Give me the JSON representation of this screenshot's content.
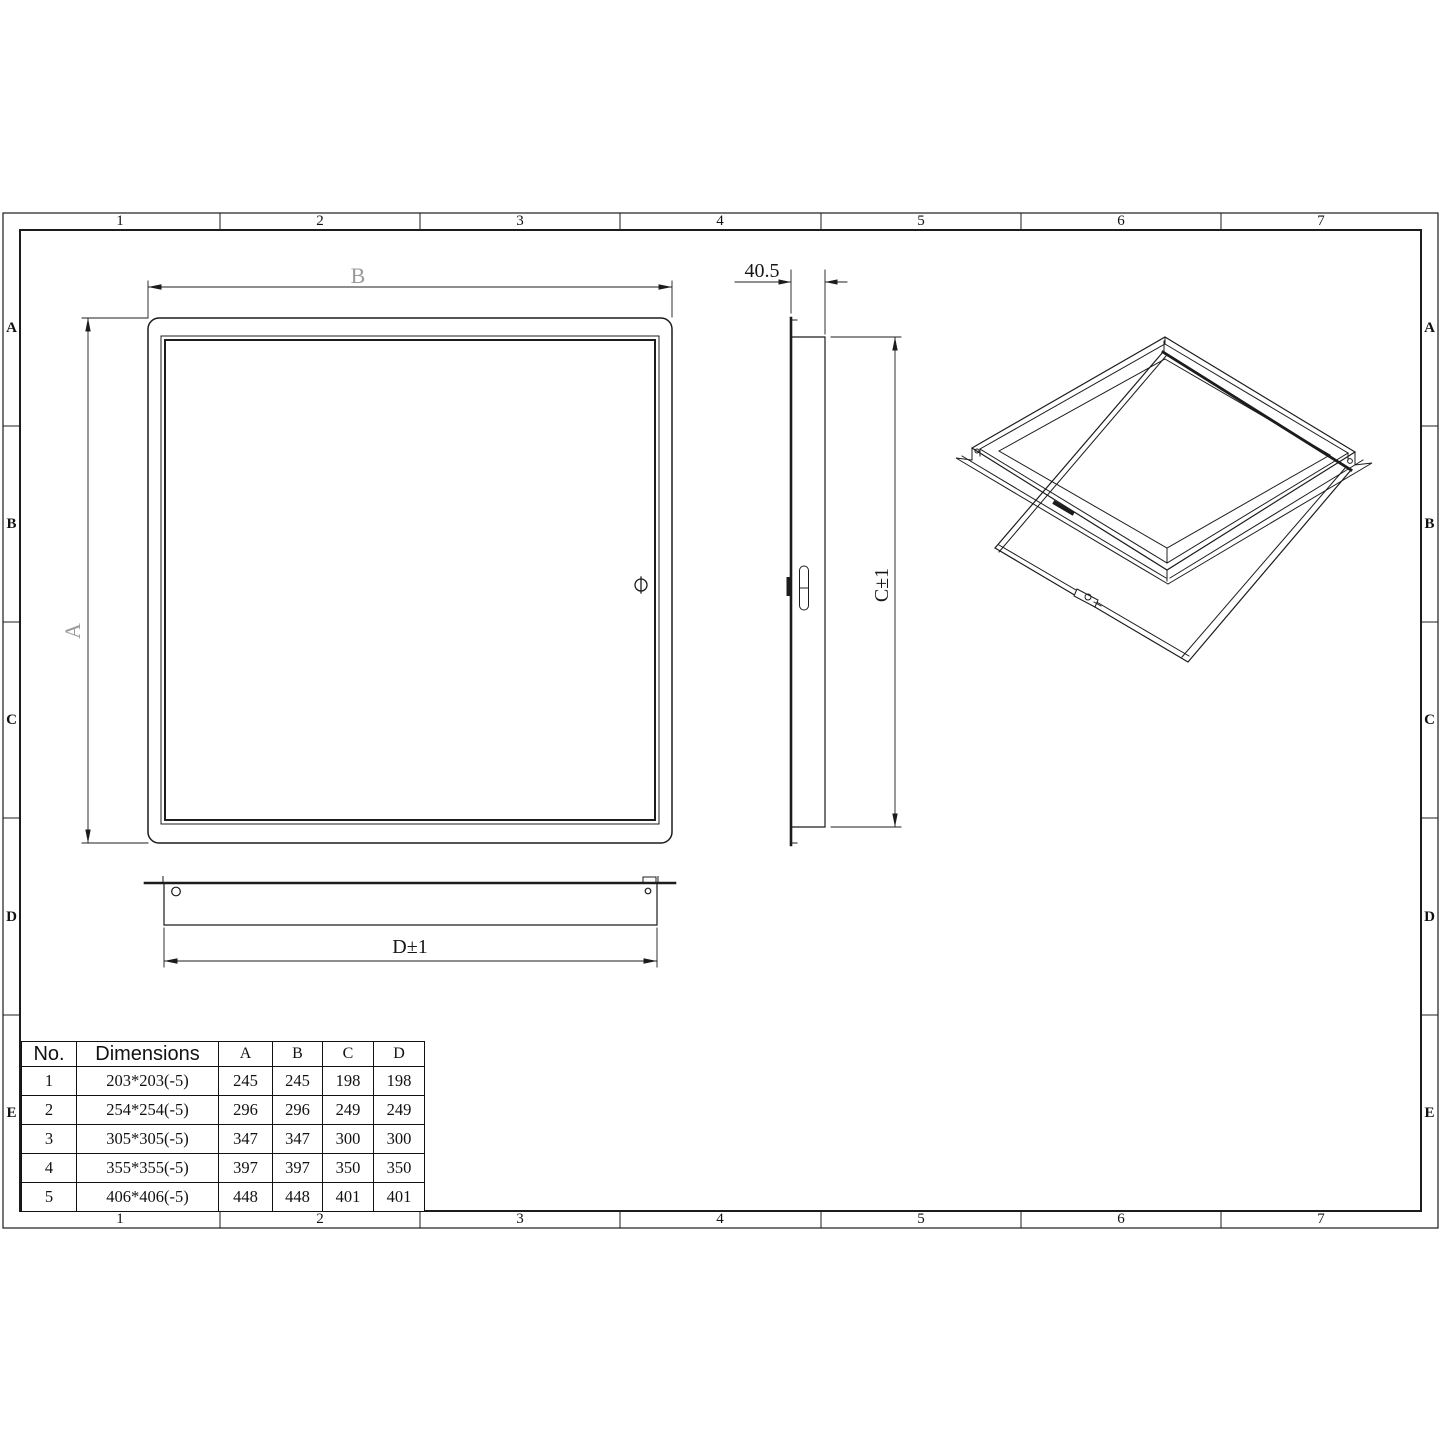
{
  "sheet": {
    "column_labels": [
      "1",
      "2",
      "3",
      "4",
      "5",
      "6",
      "7"
    ],
    "row_labels": [
      "A",
      "B",
      "C",
      "D",
      "E"
    ]
  },
  "dimensions": {
    "front_width": "B",
    "front_height": "A",
    "side_depth": "40.5",
    "side_height": "C±1",
    "bottom_width": "D±1"
  },
  "table": {
    "headers": [
      "No.",
      "Dimensions",
      "A",
      "B",
      "C",
      "D"
    ],
    "rows": [
      [
        "1",
        "203*203(-5)",
        "245",
        "245",
        "198",
        "198"
      ],
      [
        "2",
        "254*254(-5)",
        "296",
        "296",
        "249",
        "249"
      ],
      [
        "3",
        "305*305(-5)",
        "347",
        "347",
        "300",
        "300"
      ],
      [
        "4",
        "355*355(-5)",
        "397",
        "397",
        "350",
        "350"
      ],
      [
        "5",
        "406*406(-5)",
        "448",
        "448",
        "401",
        "401"
      ]
    ]
  },
  "colors": {
    "line": "#1c1c1c",
    "dim_label_gray": "#9a9a9a"
  }
}
